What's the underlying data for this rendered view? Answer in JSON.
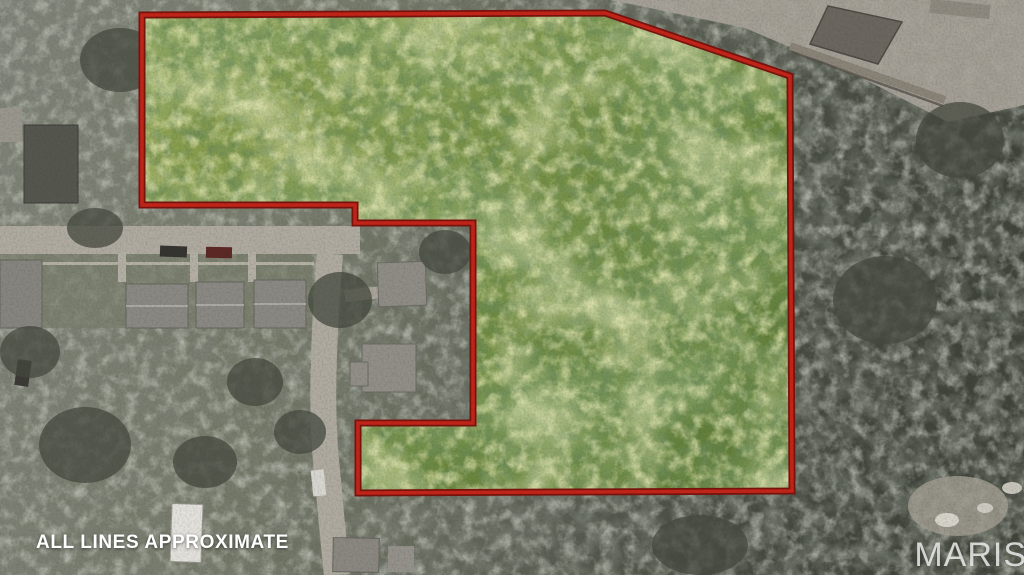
{
  "annotations": {
    "disclaimer": "ALL LINES APPROXIMATE",
    "watermark": "MARIS"
  },
  "boundary": {
    "points": "142,15 605,13 790,76 792,491 358,493 358,423 473,423 473,223 355,223 355,205 142,205",
    "line_color": "#c52418",
    "edge_color": "#7a120c"
  },
  "palette": {
    "parcel_green_light": "#9aab58",
    "parcel_green_dark": "#5d7a37",
    "surroundings_gray": "#5f6357",
    "pavement_gray": "#b2ada2",
    "roof_gray": "#8b8983",
    "disclaimer_text": "#ffffff",
    "watermark_text": "#f3f3f1"
  }
}
